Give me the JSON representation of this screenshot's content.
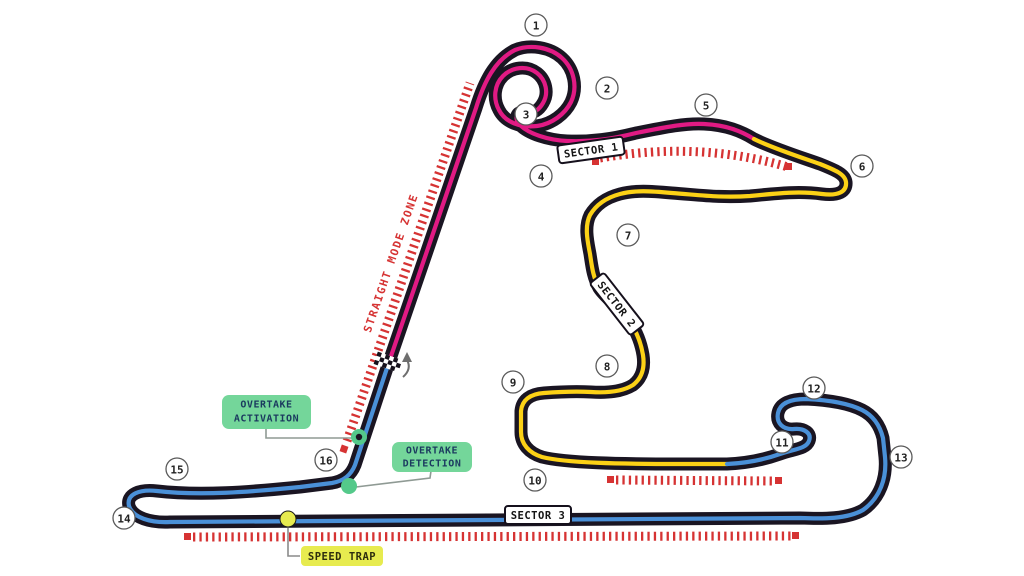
{
  "turns": [
    "1",
    "2",
    "3",
    "4",
    "5",
    "6",
    "7",
    "8",
    "9",
    "10",
    "11",
    "12",
    "13",
    "14",
    "15",
    "16"
  ],
  "sectors": [
    "SECTOR 1",
    "SECTOR 2",
    "SECTOR 3"
  ],
  "straight_zone_label": "STRAIGHT MODE ZONE",
  "labels": {
    "overtake_activation": {
      "line1": "OVERTAKE",
      "line2": "ACTIVATION"
    },
    "overtake_detection": {
      "line1": "OVERTAKE",
      "line2": "DETECTION"
    },
    "speed_trap": "SPEED TRAP"
  },
  "colors": {
    "track": "#1a1522",
    "sector1_pink": "#e11a84",
    "sector2_yellow": "#fcd116",
    "sector3_blue": "#4a90d8",
    "drs_red": "#d63333",
    "marker_green": "#54c98a",
    "label_green": "#74d69a",
    "label_text_navy": "#1b3a5f",
    "speed_trap_yellow": "#e7eb4f",
    "background": "#ffffff"
  }
}
